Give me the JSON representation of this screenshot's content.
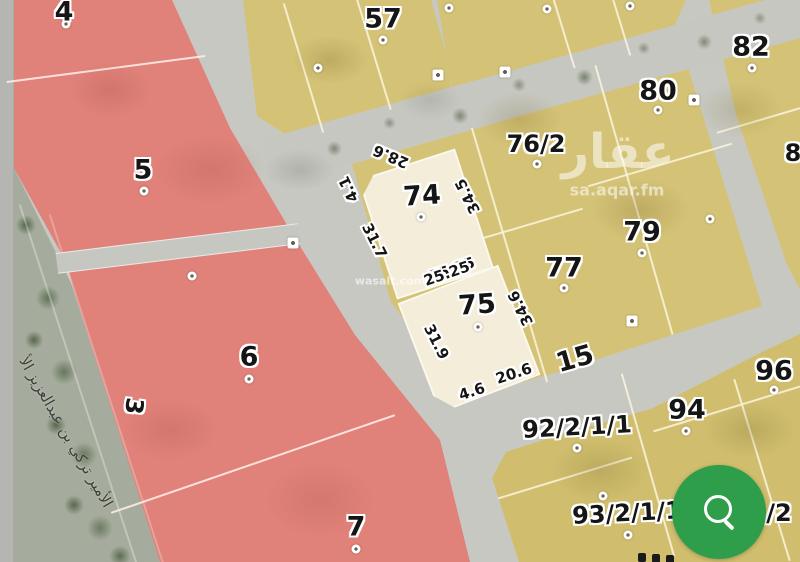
{
  "map": {
    "parcels": [
      {
        "id": "4",
        "zone": "red"
      },
      {
        "id": "5",
        "zone": "red"
      },
      {
        "id": "6",
        "zone": "red"
      },
      {
        "id": "7",
        "zone": "red"
      },
      {
        "id": "57",
        "zone": "yellow"
      },
      {
        "id": "74",
        "zone": "highlighted"
      },
      {
        "id": "75",
        "zone": "highlighted"
      },
      {
        "id": "76/2",
        "zone": "yellow"
      },
      {
        "id": "77",
        "zone": "yellow"
      },
      {
        "id": "79",
        "zone": "yellow"
      },
      {
        "id": "80",
        "zone": "yellow"
      },
      {
        "id": "82",
        "zone": "yellow"
      },
      {
        "id": "94",
        "zone": "yellow"
      },
      {
        "id": "96",
        "zone": "yellow"
      },
      {
        "id": "92/2/1/1",
        "zone": "yellow"
      },
      {
        "id": "93/2/1/1",
        "zone": "yellow"
      },
      {
        "id": "/2",
        "zone": "yellow"
      },
      {
        "id": "8",
        "zone": "yellow"
      }
    ],
    "dimensions": [
      {
        "value": "28.6"
      },
      {
        "value": "4.1"
      },
      {
        "value": "31.7"
      },
      {
        "value": "34.5"
      },
      {
        "value": "34.6"
      },
      {
        "value": "31.9"
      },
      {
        "value": "4.6"
      },
      {
        "value": "20.6"
      },
      {
        "value": "25.25"
      },
      {
        "value": "25.25"
      }
    ],
    "streets": {
      "boulevard_name": "الأمير تركي بن عبدالعزيز الأ",
      "street_number_3": "3",
      "street_number_15": "15"
    }
  },
  "watermarks": {
    "brand": "عقار",
    "brand_domain": "sa.aqar.fm",
    "partner": "wasalt.com"
  },
  "fab": {
    "action": "search",
    "color": "#2f9e4a"
  },
  "colors": {
    "road": "#c7c8c1",
    "red_parcel": "#e0827a",
    "yellow_parcel": "#d4c376",
    "highlight_parcel": "#f3edda",
    "boulevard": "#a6ac9d"
  }
}
